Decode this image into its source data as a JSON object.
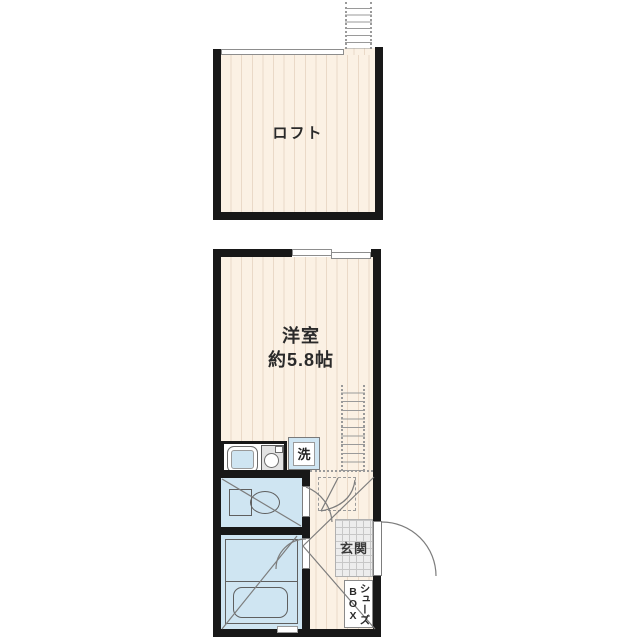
{
  "plan": {
    "loft_label": "ロフト",
    "main_room_label_line1": "洋室",
    "main_room_label_line2": "約5.8帖",
    "laundry_label": "洗",
    "entrance_label": "玄関",
    "shoebox_label_kana": "シューズ",
    "shoebox_label_latin": "BOX"
  },
  "colors": {
    "wall": "#181818",
    "floor": "#fbf1e4",
    "floor_stripe": "#ead9c7",
    "wet_area": "#cfe5f2",
    "entrance_tile": "#ededed",
    "line_gray": "#9a9a9a"
  }
}
